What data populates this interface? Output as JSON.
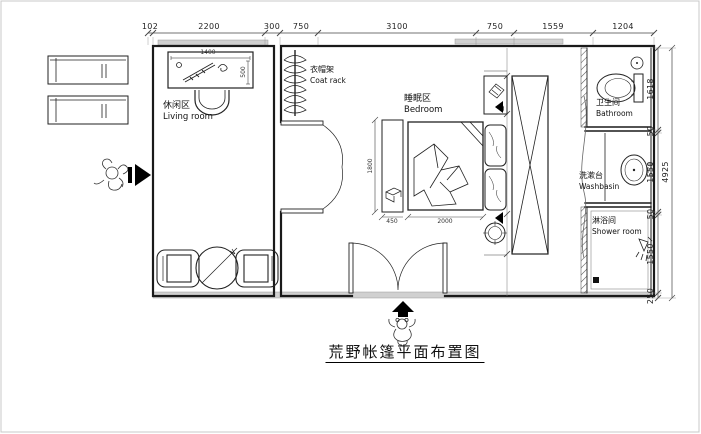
{
  "title": "荒野帐篷平面布置图",
  "colors": {
    "line": "#1a1a1a",
    "dim_text": "#222222",
    "wall_band": "#d0d0d0",
    "paper_border": "#c8c8c8"
  },
  "rooms": {
    "living": {
      "zh": "休闲区",
      "en": "Living room"
    },
    "coat_rack": {
      "zh": "衣帽架",
      "en": "Coat rack"
    },
    "bedroom": {
      "zh": "睡眠区",
      "en": "Bedroom"
    },
    "bathroom": {
      "zh": "卫生间",
      "en": "Bathroom"
    },
    "washbasin": {
      "zh": "洗漱台",
      "en": "Washbasin"
    },
    "shower": {
      "zh": "淋浴间",
      "en": "Shower room"
    }
  },
  "dimensions": {
    "top": [
      "102",
      "2200",
      "300",
      "750",
      "3100",
      "750",
      "1559",
      "1204"
    ],
    "right": [
      "1618",
      "50",
      "1550",
      "50",
      "1550",
      "250"
    ],
    "right_total": "4925",
    "desk_width": "1400",
    "desk_depth": "500",
    "bed_length": "1800",
    "bed_width": "2000",
    "bench_width": "450"
  },
  "icons": {
    "entry_left": "right-arrow",
    "entry_bottom": "up-arrow",
    "mascot": "teddy-bear-sketch",
    "drain": "floor-drain-square"
  }
}
